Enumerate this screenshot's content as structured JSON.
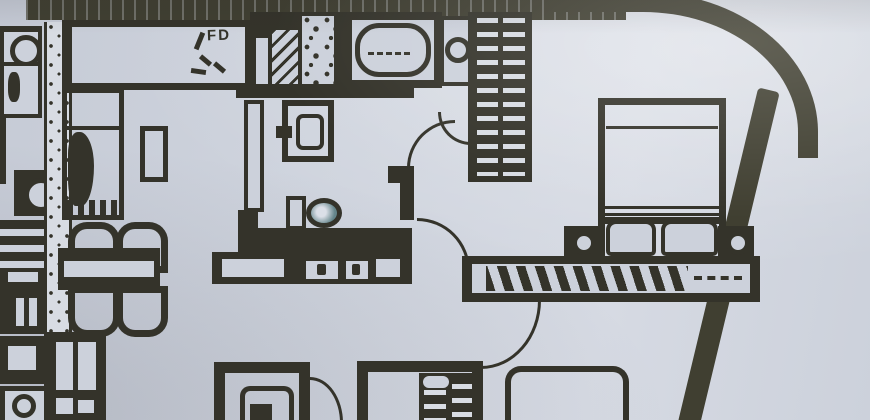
{
  "document": {
    "kind": "Scanned apartment floor plan photograph"
  },
  "labels": {
    "fd": "FD"
  },
  "colors": {
    "paper": "#ccd1db",
    "paper_light": "#dbdfe7",
    "ink": "#34332a",
    "ink_soft": "#403f31",
    "speckle": "#d8dce3",
    "toilet_water": "#64858a"
  },
  "fixtures": [
    "exterior-wall-top",
    "exterior-wall-curved-corner",
    "exterior-wall-diagonal",
    "party-wall",
    "fd-closet",
    "service-shafts",
    "bathtub",
    "washing-machine",
    "shelf-closet",
    "single-bed",
    "side-table",
    "dining-table",
    "dining-chairs",
    "kitchen-cabinets",
    "bathroom-door",
    "vanity-sink",
    "toilet",
    "vanity-counter",
    "door-swing-hall",
    "door-swing-living",
    "door-swing-washer",
    "door-swing-bedroom",
    "door-swing-shower-room",
    "double-bed",
    "pillows",
    "nightstands",
    "table-lamps",
    "long-wardrobe",
    "slatted-wardrobe",
    "shower",
    "bottom-room-furniture",
    "adjacent-unit-appliances"
  ]
}
